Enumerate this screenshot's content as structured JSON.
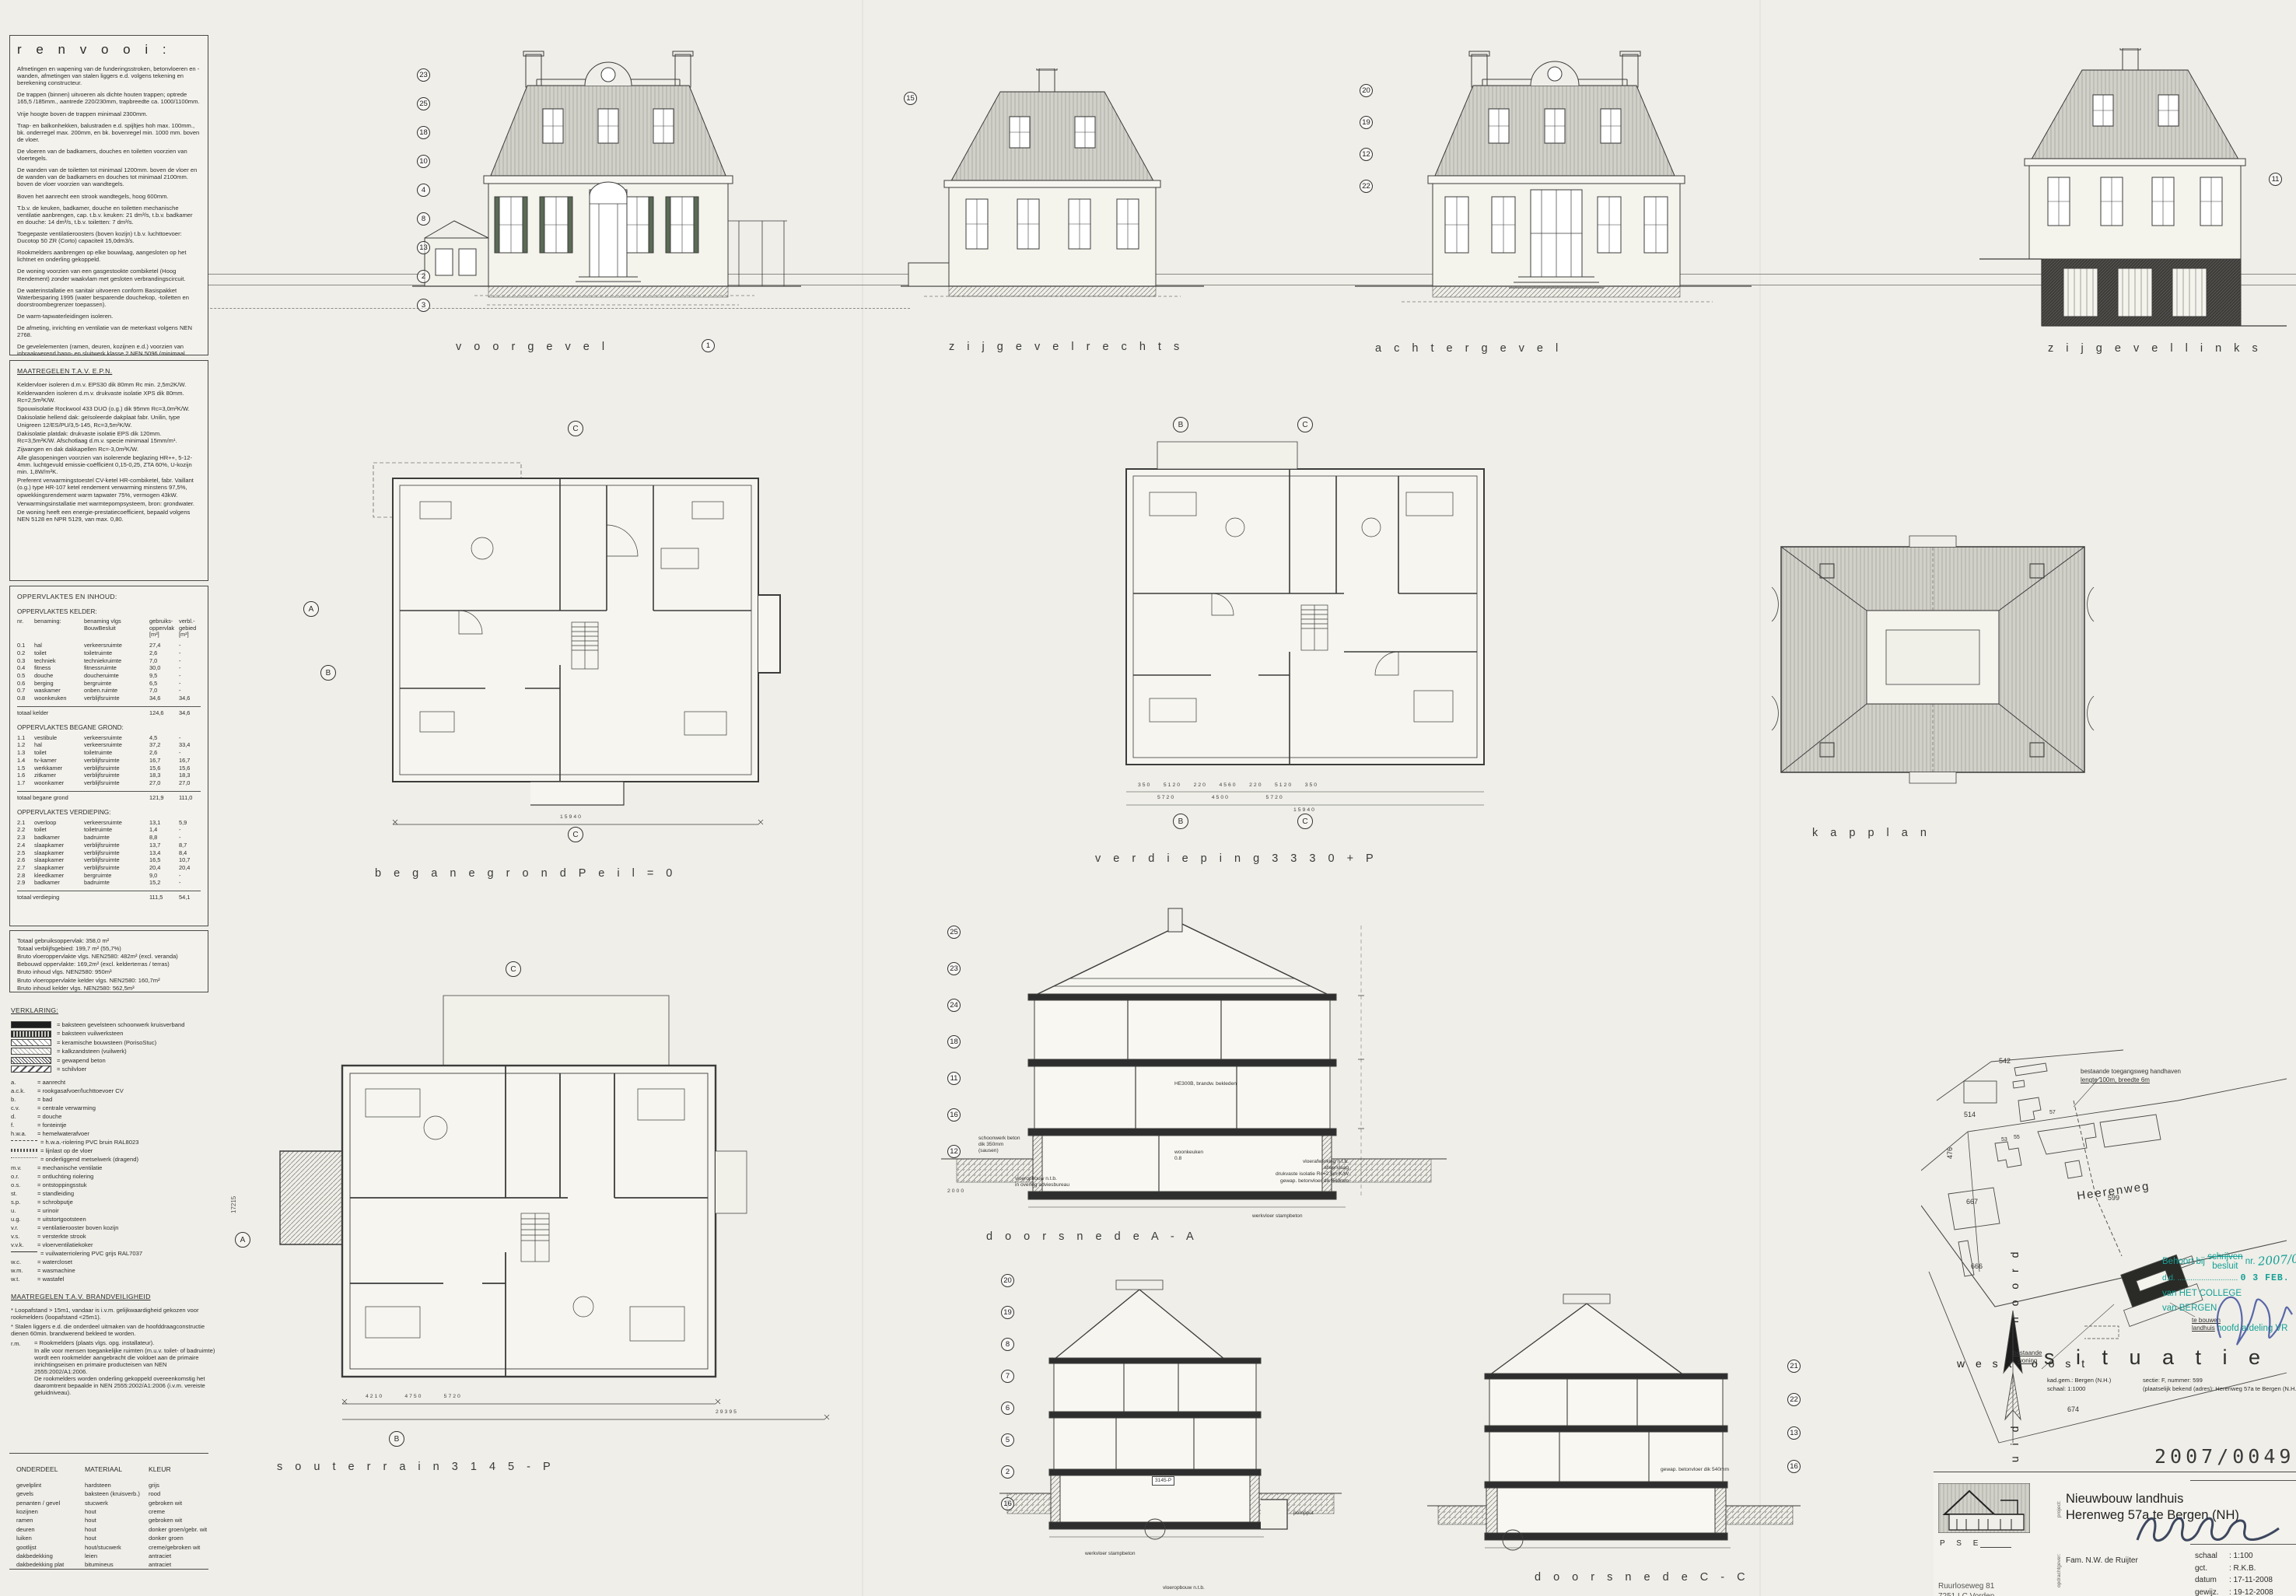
{
  "renvooi": {
    "title": "r e n v o o i :",
    "paragraphs": [
      "Afmetingen en wapening van de funderingsstroken, betonvloeren en -wanden, afmetingen van stalen liggers e.d. volgens tekening en berekening constructeur.",
      "De trappen (binnen) uitvoeren als dichte houten trappen; optrede 165,5 /185mm., aantrede 220/230mm, trapbreedte ca. 1000/1100mm.",
      "Vrije hoogte boven de trappen minimaal 2300mm.",
      "Trap- en balkonhekken, balustraden e.d. spijltjes hoh max. 100mm., bk. onderregel max. 200mm, en bk. bovenregel min. 1000 mm. boven de vloer.",
      "De vloeren van de badkamers, douches en toiletten voorzien van vloertegels.",
      "De wanden van de toiletten tot minimaal 1200mm. boven de vloer en de wanden van de badkamers en douches tot minimaal 2100mm. boven de vloer voorzien van wandtegels.",
      "Boven het aanrecht een strook wandtegels, hoog 600mm.",
      "T.b.v. de keuken, badkamer, douche en toiletten mechanische ventilatie aanbrengen, cap. t.b.v. keuken: 21 dm³/s, t.b.v. badkamer en douche: 14 dm³/s, t.b.v. toiletten: 7 dm³/s.",
      "Toegepaste ventilatieroosters (boven kozijn) t.b.v. luchttoevoer: Ducotop 50 ZR (Corto) capaciteit 15,0dm3/s.",
      "Rookmelders aanbrengen op elke bouwlaag, aangesloten op het lichtnet en onderling gekoppeld.",
      "De woning voorzien van een gasgestookte combiketel (Hoog Rendement) zonder waakvlam met gesloten verbrandingscircuit.",
      "De waterinstallatie en sanitair uitvoeren conform Basispakket Waterbesparing 1995 (water besparende douchekop, -toiletten en doorstroombegrenzer toepassen).",
      "De warm-tapwaterleidingen isoleren.",
      "De afmeting, inrichting en ventilatie van de meterkast volgens NEN 2768.",
      "De gevelelementen (ramen, deuren, kozijnen e.d.) voorzien van inbraakwerend hang- en sluitwerk klasse 2 NEN 5096 (minimaal SKG**).",
      "Binnendeuren uitvoeren als stompe deuren 930x2315mm, tenzij anders vermeld."
    ]
  },
  "epn": {
    "title": "MAATREGELEN T.A.V. E.P.N.",
    "paragraphs": [
      "Keldervloer isoleren d.m.v. EPS30 dik 80mm Rc min. 2,5m2K/W.",
      "Kelderwanden isoleren d.m.v. drukvaste isolatie XPS dik 80mm. Rc=2,5m²K/W.",
      "Spouwisolatie Rockwool 433 DUO (o.g.) dik 95mm Rc=3,0m²K/W.",
      "Dakisolatie hellend dak: geïsoleerde dakplaat fabr. Unilin, type Unigreen 12/ES/PU/3,5-145, Rc=3,5m²K/W.",
      "Dakisolatie platdak: drukvaste isolatie EPS dik 120mm. Rc=3,5m²K/W. Afschotlaag d.m.v. specie minimaal 15mm/m¹.",
      "Zijwangen en dak dakkapellen Rc=-3,0m²K/W.",
      "Alle glasopeningen voorzien van isolerende beglazing HR++, 5-12-4mm. luchtgevuld emissie-coëfficiënt 0,15-0,25, ZTA 60%, U-kozijn min. 1,8W/m²K.",
      "Preferent verwarmingstoestel CV-ketel HR-combiketel, fabr. Vaillant (o.g.) type HR-107 ketel rendement verwarming minstens 97,5%, opwekkingsrendement warm tapwater 75%, vermogen 43kW.",
      "Verwarmingsinstallatie met warmtepompsysteem, bron: grondwater.",
      "De woning heeft een energie-prestatiecoefficient, bepaald volgens NEN 5128 en NPR 5129, van max. 0,80."
    ]
  },
  "oppervlaktes": {
    "title": "OPPERVLAKTES EN INHOUD:",
    "header": "nr.\tbenaming:\tbenaming vlgs BouwBesluit\tgebruiks-oppervlak [m²]\tverbl.-gebied [m²]",
    "head_cols": [
      "nr.",
      "benaming:",
      "benaming vlgs\nBouwBesluit",
      "gebruiks-\noppervlak\n[m²]",
      "verbl.-\ngebied\n[m²]"
    ],
    "kelder": {
      "title": "OPPERVLAKTES KELDER:",
      "rows": [
        [
          "0.1",
          "hal",
          "verkeersruimte",
          "27,4",
          "-"
        ],
        [
          "0.2",
          "toilet",
          "toiletruimte",
          "2,6",
          "-"
        ],
        [
          "0.3",
          "techniek",
          "techniekruimte",
          "7,0",
          "-"
        ],
        [
          "0.4",
          "fitness",
          "fitnessruimte",
          "30,0",
          "-"
        ],
        [
          "0.5",
          "douche",
          "doucheruimte",
          "9,5",
          "-"
        ],
        [
          "0.6",
          "berging",
          "bergruimte",
          "6,5",
          "-"
        ],
        [
          "0.7",
          "waskamer",
          "onben.ruimte",
          "7,0",
          "-"
        ],
        [
          "0.8",
          "woonkeuken",
          "verblijfsruimte",
          "34,6",
          "34,6"
        ]
      ],
      "total": [
        "totaal kelder",
        "124,6",
        "34,6"
      ]
    },
    "begane_grond": {
      "title": "OPPERVLAKTES BEGANE GROND:",
      "rows": [
        [
          "1.1",
          "vestibule",
          "verkeersruimte",
          "4,5",
          "-"
        ],
        [
          "1.2",
          "hal",
          "verkeersruimte",
          "37,2",
          "33,4"
        ],
        [
          "1.3",
          "toilet",
          "toiletruimte",
          "2,6",
          "-"
        ],
        [
          "1.4",
          "tv-kamer",
          "verblijfsruimte",
          "16,7",
          "16,7"
        ],
        [
          "1.5",
          "werkkamer",
          "verblijfsruimte",
          "15,6",
          "15,6"
        ],
        [
          "1.6",
          "zitkamer",
          "verblijfsruimte",
          "18,3",
          "18,3"
        ],
        [
          "1.7",
          "woonkamer",
          "verblijfsruimte",
          "27,0",
          "27,0"
        ]
      ],
      "total": [
        "totaal begane grond",
        "121,9",
        "111,0"
      ]
    },
    "verdieping": {
      "title": "OPPERVLAKTES VERDIEPING:",
      "rows": [
        [
          "2.1",
          "overloop",
          "verkeersruimte",
          "13,1",
          "5,9"
        ],
        [
          "2.2",
          "toilet",
          "toiletruimte",
          "1,4",
          "-"
        ],
        [
          "2.3",
          "badkamer",
          "badruimte",
          "8,8",
          "-"
        ],
        [
          "2.4",
          "slaapkamer",
          "verblijfsruimte",
          "13,7",
          "8,7"
        ],
        [
          "2.5",
          "slaapkamer",
          "verblijfsruimte",
          "13,4",
          "8,4"
        ],
        [
          "2.6",
          "slaapkamer",
          "verblijfsruimte",
          "16,5",
          "10,7"
        ],
        [
          "2.7",
          "slaapkamer",
          "verblijfsruimte",
          "20,4",
          "20,4"
        ],
        [
          "2.8",
          "kleedkamer",
          "bergruimte",
          "9,0",
          "-"
        ],
        [
          "2.9",
          "badkamer",
          "badruimte",
          "15,2",
          "-"
        ]
      ],
      "total": [
        "totaal verdieping",
        "111,5",
        "54,1"
      ]
    },
    "totals": [
      "Totaal gebruiksoppervlak: 358,0 m²",
      "Totaal verblijfsgebied: 199,7 m² (55,7%)",
      "Bruto vloeroppervlakte vlgs. NEN2580: 482m² (excl. veranda)",
      "Bebouwd oppervlakte: 169,2m² (excl. kelderterras / terras)",
      "Bruto inhoud vlgs. NEN2580: 950m³",
      "Bruto vloeroppervlakte kelder vlgs. NEN2580: 160,7m²",
      "Bruto inhoud kelder vlgs. NEN2580: 562,5m³"
    ]
  },
  "verklaring": {
    "title": "VERKLARING:",
    "hatches": [
      {
        "sw": "sw-solid",
        "v": "= baksteen gevelsteen schoonwerk kruisverband"
      },
      {
        "sw": "sw-speck",
        "v": "= baksteen vuilwerksteen"
      },
      {
        "sw": "sw-diag",
        "v": "= keramische bouwsteen (PorisoStuc)"
      },
      {
        "sw": "sw-cross",
        "v": "= kalkzandsteen (vuilwerk)"
      },
      {
        "sw": "sw-dense",
        "v": "= gewapend beton"
      },
      {
        "sw": "sw-wide",
        "v": "= schilvloer"
      }
    ],
    "abbr": [
      {
        "k": "a.",
        "sw": "",
        "v": "= aanrecht"
      },
      {
        "k": "a.c.k.",
        "sw": "",
        "v": "= rookgasafvoer/luchttoevoer CV"
      },
      {
        "k": "b.",
        "sw": "",
        "v": "= bad"
      },
      {
        "k": "c.v.",
        "sw": "",
        "v": "= centrale verwarming"
      },
      {
        "k": "d.",
        "sw": "",
        "v": "= douche"
      },
      {
        "k": "f.",
        "sw": "",
        "v": "= fonteintje"
      },
      {
        "k": "h.w.a.",
        "sw": "",
        "v": "= hemelwaterafvoer"
      },
      {
        "k": "",
        "sw": "sw-hwaline",
        "v": "= h.w.a.-riolering PVC bruin RAL8023"
      },
      {
        "k": "",
        "sw": "sw-xline",
        "v": "= lijnlast op de vloer"
      },
      {
        "k": "",
        "sw": "sw-dotline",
        "v": "= onderliggend metselwerk (dragend)"
      },
      {
        "k": "m.v.",
        "sw": "",
        "v": "= mechanische ventilatie"
      },
      {
        "k": "o.r.",
        "sw": "",
        "v": "= ontluchting riolering"
      },
      {
        "k": "o.s.",
        "sw": "",
        "v": "= ontstoppingsstuk"
      },
      {
        "k": "st.",
        "sw": "",
        "v": "= standleiding"
      },
      {
        "k": "s.p.",
        "sw": "",
        "v": "= schrobputje"
      },
      {
        "k": "u.",
        "sw": "",
        "v": "= urinoir"
      },
      {
        "k": "u.g.",
        "sw": "",
        "v": "= uitstortgootsteen"
      },
      {
        "k": "v.r.",
        "sw": "",
        "v": "= ventilatierooster boven kozijn"
      },
      {
        "k": "v.s.",
        "sw": "",
        "v": "= versterkte strook"
      },
      {
        "k": "v.v.k.",
        "sw": "",
        "v": "= vloerventilatiekoker"
      },
      {
        "k": "",
        "sw": "sw-solidline",
        "v": "= vuilwaterriolering PVC grijs RAL7037"
      },
      {
        "k": "w.c.",
        "sw": "",
        "v": "= watercloset"
      },
      {
        "k": "w.m.",
        "sw": "",
        "v": "= wasmachine"
      },
      {
        "k": "w.t.",
        "sw": "",
        "v": "= wastafel"
      }
    ]
  },
  "brandveiligheid": {
    "title": "MAATREGELEN T.A.V. BRANDVEILIGHEID",
    "items": [
      "* Loopafstand > 15m1, vandaar is i.v.m. gelijkwaardigheid gekozen voor rookmelders (loopafstand <25m1).",
      "* Stalen liggers e.d. die onderdeel uitmaken van de hoofddraagconstructie dienen 60min. brandwerend bekleed te worden."
    ],
    "rm_key": "r.m.",
    "rm_note": "= Rookmelders (plaats vlgs. opg. installateur).\nIn alle voor mensen toegankelijke ruimten (m.u.v. toilet- of badruimte) wordt een rookmelder aangebracht die voldoet aan de primaire inrichtingseisen en primaire producteisen van NEN 2555:2002/A1:2006.\nDe rookmelders worden onderling gekoppeld overeenkomstig het daaromtrent bepaalde in NEN 2555:2002/A1:2006 (i.v.m. vereiste geluidniveau)."
  },
  "materialen": {
    "headers": [
      "ONDERDEEL",
      "MATERIAAL",
      "KLEUR"
    ],
    "rows": [
      [
        "gevelplint",
        "hardsteen",
        "grijs"
      ],
      [
        "gevels",
        "baksteen (kruisverb.)",
        "rood"
      ],
      [
        "penanten / gevel",
        "stucwerk",
        "gebroken wit"
      ],
      [
        "kozijnen",
        "hout",
        "creme"
      ],
      [
        "ramen",
        "hout",
        "gebroken wit"
      ],
      [
        "deuren",
        "hout",
        "donker groen/gebr. wit"
      ],
      [
        "luiken",
        "hout",
        "donker groen"
      ],
      [
        "gootlijst",
        "hout/stucwerk",
        "creme/gebroken wit"
      ],
      [
        "dakbedekking",
        "leien",
        "antraciet"
      ],
      [
        "dakbedekking plat",
        "bitumineus",
        "antraciet"
      ]
    ]
  },
  "captions": {
    "voorgevel": "v o o r g e v e l",
    "voorgevel_marker": "1",
    "zijgevel_rechts": "z i j g e v e l   r e c h t s",
    "achtergevel": "a c h t e r g e v e l",
    "zijgevel_links": "z i j g e v e l   l i n k s",
    "begane_grond": "b e g a n e   g r o n d   P e i l = 0",
    "verdieping": "v e r d i e p i n g   3 3 3 0 + P",
    "kapplan": "k a p p l a n",
    "souterrain": "s o u t e r r a i n   3 1 4 5 - P",
    "doorsnede_aa": "d o o r s n e d e   A - A",
    "doorsnede_cc": "d o o r s n e d e   C - C"
  },
  "dimensions": {
    "begane_grond_total": "15940",
    "verdieping_row1": "350    5120    220    4560    220    5120    350",
    "verdieping_row2": "5720            4500            5720",
    "verdieping_total": "15940",
    "souterrain_row": "4210       4750       5720",
    "souterrain_total": "29395",
    "aa_left": "2000"
  },
  "annotations": {
    "aa_left1": "schoonwerk beton\ndik 350mm\n(sausen)",
    "aa_left2": "vloeropbouw n.t.b.\nin overleg adviesbureau",
    "aa_room": "woonkeuken\n0.8",
    "aa_beam": "HE300B, brandw. bekleden",
    "aa_right": "vloerafwerking n.t.b.\nafwerklaag\ndrukvaste isolatie Rc=2.5m²K/W\ngewap. betonvloer dik 540mm",
    "aa_bottom": "werkvloer stampbeton",
    "bb_level": "3145-P",
    "bb_pompput": "pompput",
    "bb_bottom": "werkvloer stampbeton",
    "bb_floor": "vloeropbouw n.t.b.",
    "cc_floor": "gewap. betonvloer dik 540mm"
  },
  "markers": {
    "voorgevel": [
      "23",
      "25",
      "18",
      "10",
      "4",
      "8",
      "13",
      "2",
      "3"
    ],
    "zijgevel_rechts": [
      "15"
    ],
    "achtergevel": [
      "20",
      "19",
      "12",
      "22"
    ],
    "zijgevel_links": [
      "11"
    ],
    "doorsnede_aa": [
      "25",
      "23",
      "24",
      "18",
      "11",
      "16",
      "12"
    ],
    "doorsnede_bb": [
      "20",
      "19",
      "8",
      "7",
      "6",
      "5",
      "2",
      "16"
    ],
    "doorsnede_cc": [
      "21",
      "22",
      "13",
      "16"
    ],
    "grid_a": "A",
    "grid_b": "B",
    "grid_c": "C"
  },
  "situatie": {
    "title": "s i t u a t i e",
    "meta_left": "kad.gem.: Bergen (N.H.)\nschaal: 1:1000",
    "meta_right": "sectie: F, nummer: 599\n(plaatselijk bekend (adres): Herenweg 57a te Bergen (N.H.)",
    "road": "Heerenweg",
    "parcels": {
      "p667": "667",
      "p666": "666",
      "p476": "476",
      "p542": "542",
      "p514": "514",
      "p57": "57",
      "p53": "53",
      "p55": "55",
      "p599": "599",
      "p674": "674"
    },
    "compass": {
      "noord": "n o o r d",
      "west": "w e s t",
      "oost": "o o s t",
      "zuid": "z u i d"
    },
    "ann_driveway1": "bestaande toegangsweg handhaven",
    "ann_driveway2": "lengte 100m, breedte 6m",
    "ann_woning": "bestaande\nwoning",
    "ann_landhuis": "te bouwen\nlandhuis"
  },
  "stamp": {
    "color": "#14a096",
    "behoort": "Behoort bij",
    "schrijven": "schrijven",
    "besluit": "besluit",
    "nr": "nr.",
    "nr_hand": "2007/0",
    "dd": "d.d.  ............................",
    "date": "0 3 FEB. 2009",
    "van1": "van HET COLLEGE",
    "van2": "van BERGEN",
    "sign": "hoofd afdeling VR"
  },
  "titleblock": {
    "number": "2007/00497",
    "firm": "P S E",
    "addr1": "Ruurloseweg 81",
    "addr2": "7251 LC Vorden",
    "project_label": "project:",
    "project1": "Nieuwbouw landhuis",
    "project2": "Herenweg 57a te Bergen (NH)",
    "client_label": "opdrachtgever:",
    "client": "Fam. N.W. de Ruijter",
    "meta": [
      [
        "schaal",
        ": 1:100"
      ],
      [
        "gct.",
        ": R.K.B."
      ],
      [
        "datum",
        ": 17-11-2008"
      ],
      [
        "gewijz.",
        ": 19-12-2008"
      ]
    ]
  },
  "misc": {
    "side_number": "17215"
  }
}
